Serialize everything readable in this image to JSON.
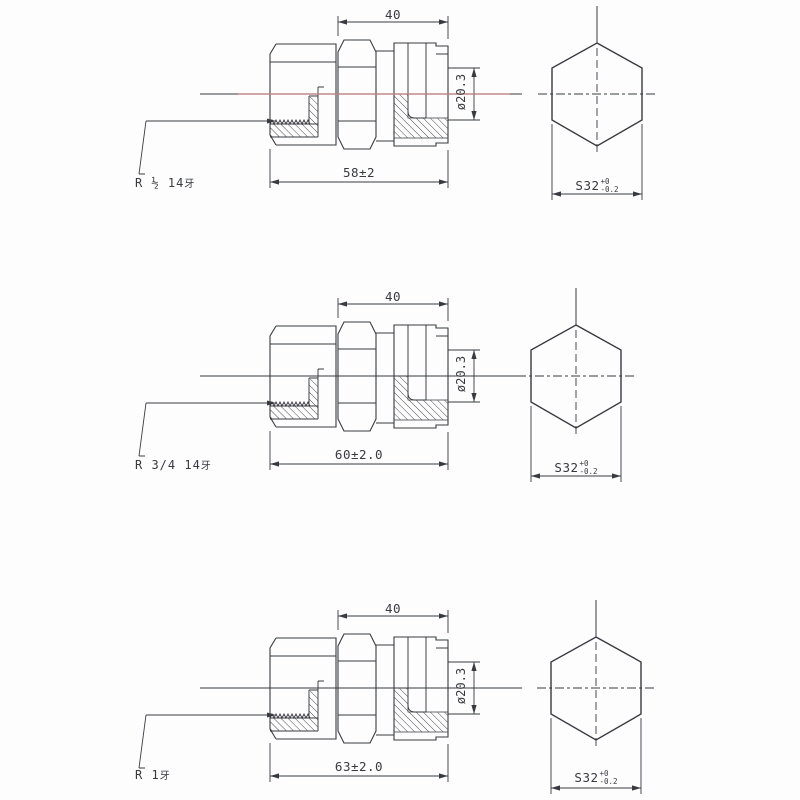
{
  "drawing": {
    "type": "technical-drawing",
    "colors": {
      "line": "#393a40",
      "centerline_accent": "#d98f8f",
      "background": "#fdfdfd"
    },
    "rows": [
      {
        "thread_label": "R ½ 14",
        "thread_label_suffix": "牙",
        "width_dim": "40",
        "length_dim": "58±2",
        "bore_dim": "ø20.3",
        "hex_width": "S32",
        "hex_tol_upper": "+0",
        "hex_tol_lower": "-0.2"
      },
      {
        "thread_label": "R 3/4 14",
        "thread_label_suffix": "牙",
        "width_dim": "40",
        "length_dim": "60±2.0",
        "bore_dim": "ø20.3",
        "hex_width": "S32",
        "hex_tol_upper": "+0",
        "hex_tol_lower": "-0.2"
      },
      {
        "thread_label": "R 1",
        "thread_label_suffix": "牙",
        "width_dim": "40",
        "length_dim": "63±2.0",
        "bore_dim": "ø20.3",
        "hex_width": "S32",
        "hex_tol_upper": "+0",
        "hex_tol_lower": "-0.2"
      }
    ]
  }
}
